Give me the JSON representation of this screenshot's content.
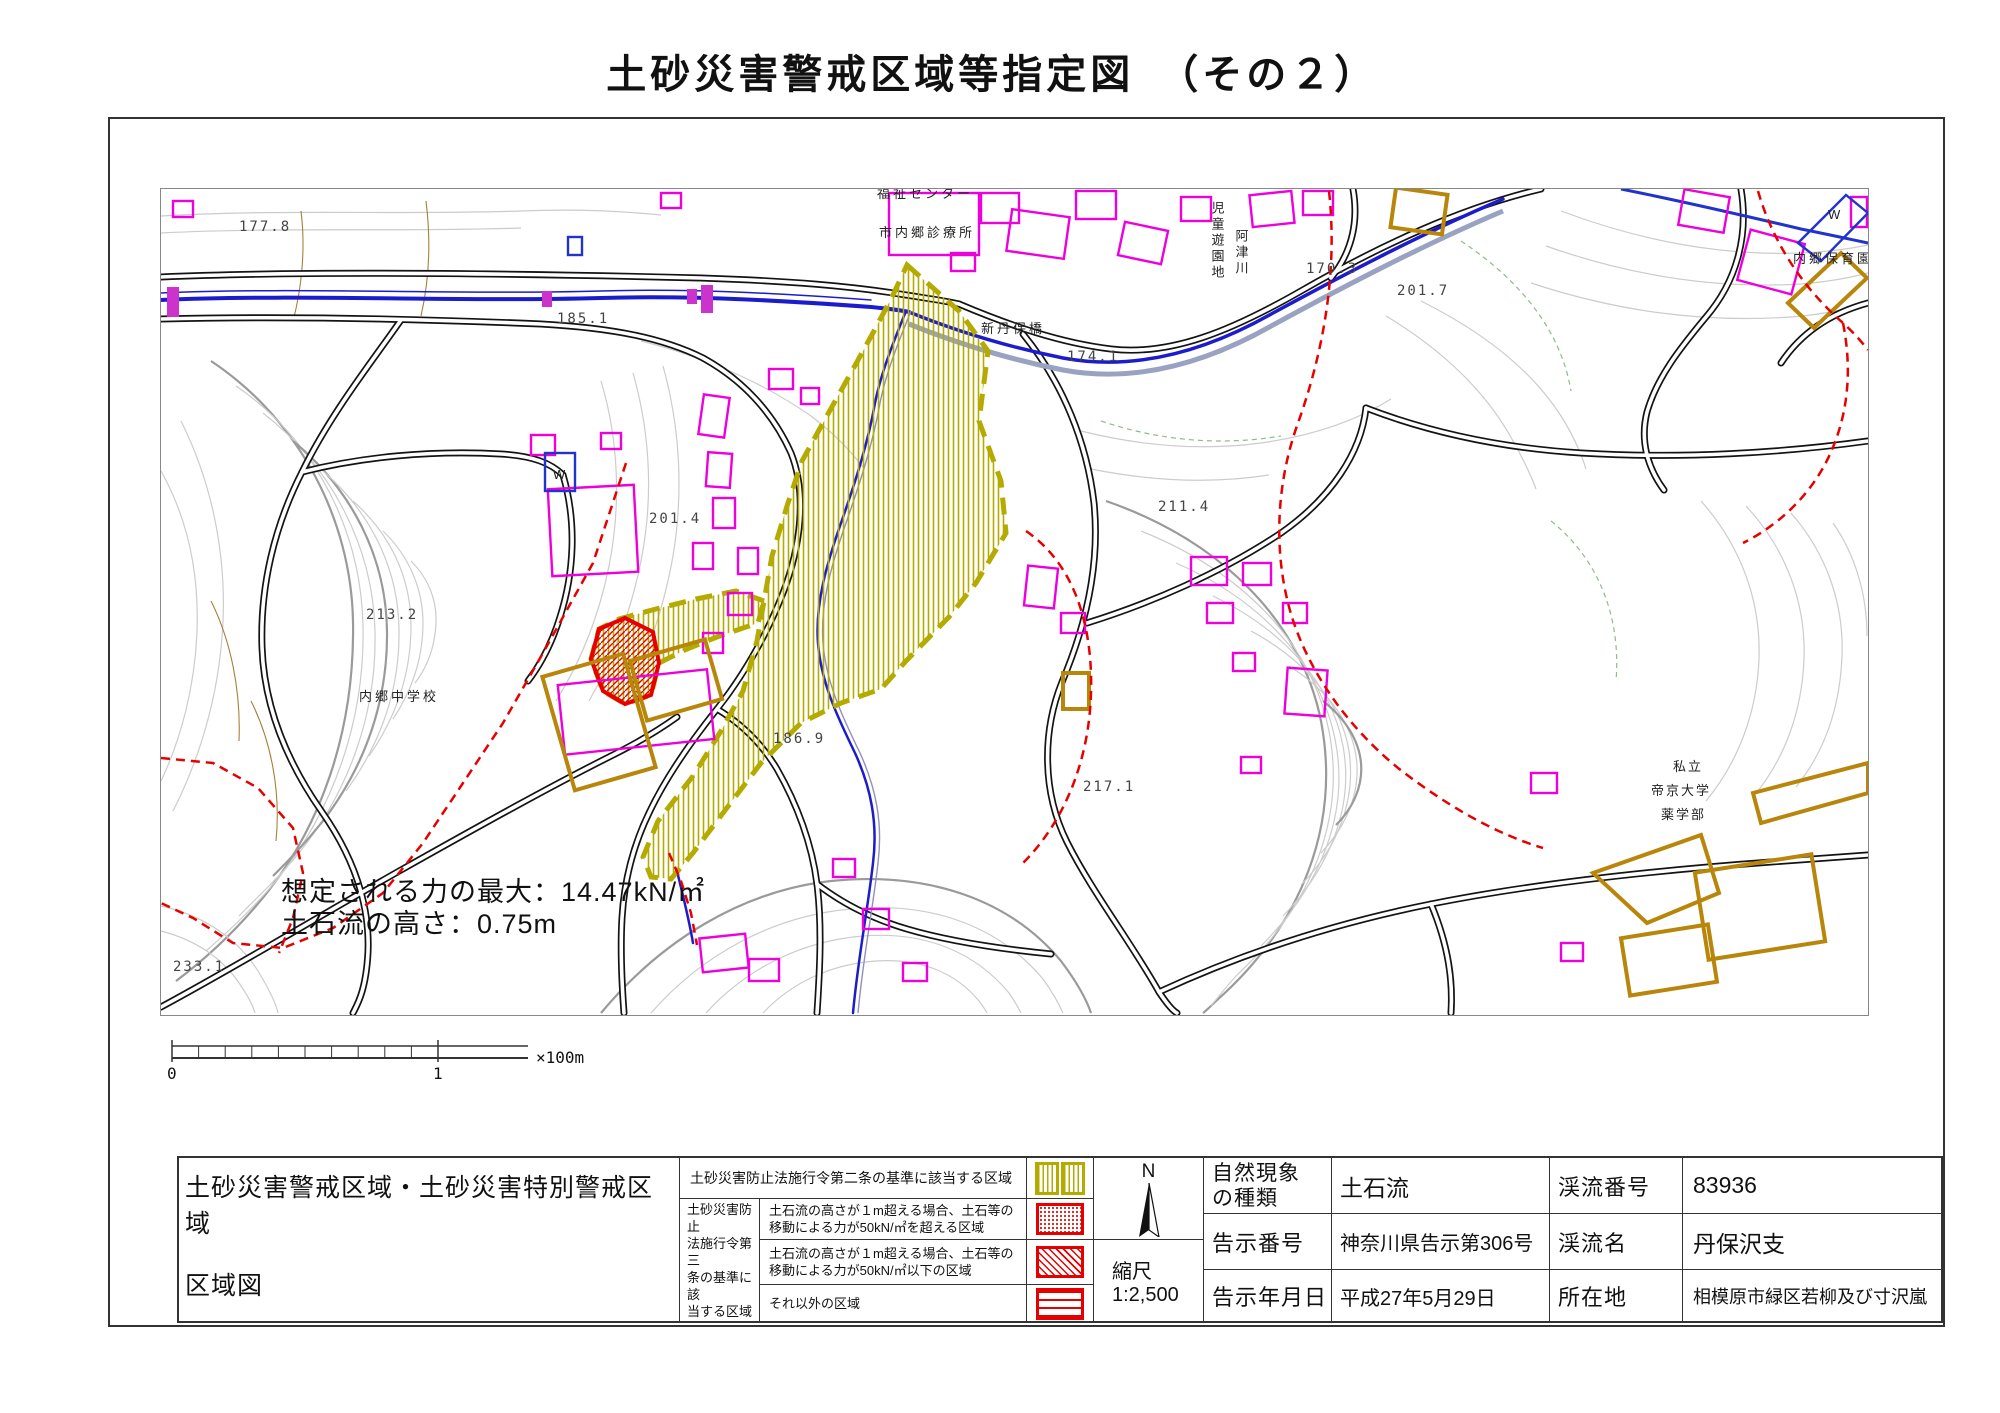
{
  "title": "土砂災害警戒区域等指定図　（その２）",
  "map_annotation": {
    "line1": "想定される力の最大：14.47kN/㎡",
    "line2": "土石流の高さ：0.75m"
  },
  "map_labels": {
    "clinic": "市内郷診療所",
    "welfare_center": "福祉センター",
    "childrens_park": "児童遊園地",
    "river_name": "阿津川",
    "bridge": "新丹保橋",
    "junior_high": "内郷中学校",
    "nursery": "内郷保育園",
    "univ_line1": "私立",
    "univ_line2": "帝京大学",
    "univ_line3": "薬学部",
    "well_w1": "W",
    "well_w2": "W"
  },
  "elevations": {
    "e1": "177.8",
    "e2": "185.1",
    "e3": "170.3",
    "e4": "174.1",
    "e5": "201.7",
    "e6": "201.4",
    "e7": "213.2",
    "e8": "211.4",
    "e9": "233.1",
    "e10": "186.9",
    "e11": "217.1"
  },
  "scalebar": {
    "zero": "0",
    "one": "1",
    "unit": "×100m"
  },
  "compass": {
    "north": "N"
  },
  "map_scale": {
    "label": "縮尺",
    "value": "1:2,500"
  },
  "legend": {
    "sheet_title_line1": "土砂災害警戒区域・土砂災害特別警戒区域",
    "sheet_title_line2": "区域図",
    "article2": "土砂災害防止法施行令第二条の基準に該当する区域",
    "article3_line1": "土砂災害防止",
    "article3_line2": "法施行令第三",
    "article3_line3": "条の基準に該",
    "article3_line4": "当する区域",
    "row2_line1": "土石流の高さが１m超える場合、土石等の",
    "row2_line2": "移動による力が50kN/㎡を超える区域",
    "row3_line1": "土石流の高さが１m超える場合、土石等の",
    "row3_line2": "移動による力が50kN/㎡以下の区域",
    "row4": "それ以外の区域"
  },
  "info": {
    "nature_label_line1": "自然現象",
    "nature_label_line2": "の種類",
    "nature_value": "土石流",
    "notice_no_label": "告示番号",
    "notice_no_value": "神奈川県告示第306号",
    "notice_date_label": "告示年月日",
    "notice_date_value": "平成27年5月29日",
    "stream_no_label": "渓流番号",
    "stream_no_value": "83936",
    "stream_name_label": "渓流名",
    "stream_name_value": "丹保沢支",
    "location_label": "所在地",
    "location_value": "相模原市緑区若柳及び寸沢嵐"
  },
  "colors": {
    "special_zone_olive": "#b4aa00",
    "zone_red": "#e60000",
    "building_magenta": "#ee00dd",
    "building_gold": "#b8860b",
    "river_blue": "#2222cc",
    "road_black": "#131313"
  }
}
